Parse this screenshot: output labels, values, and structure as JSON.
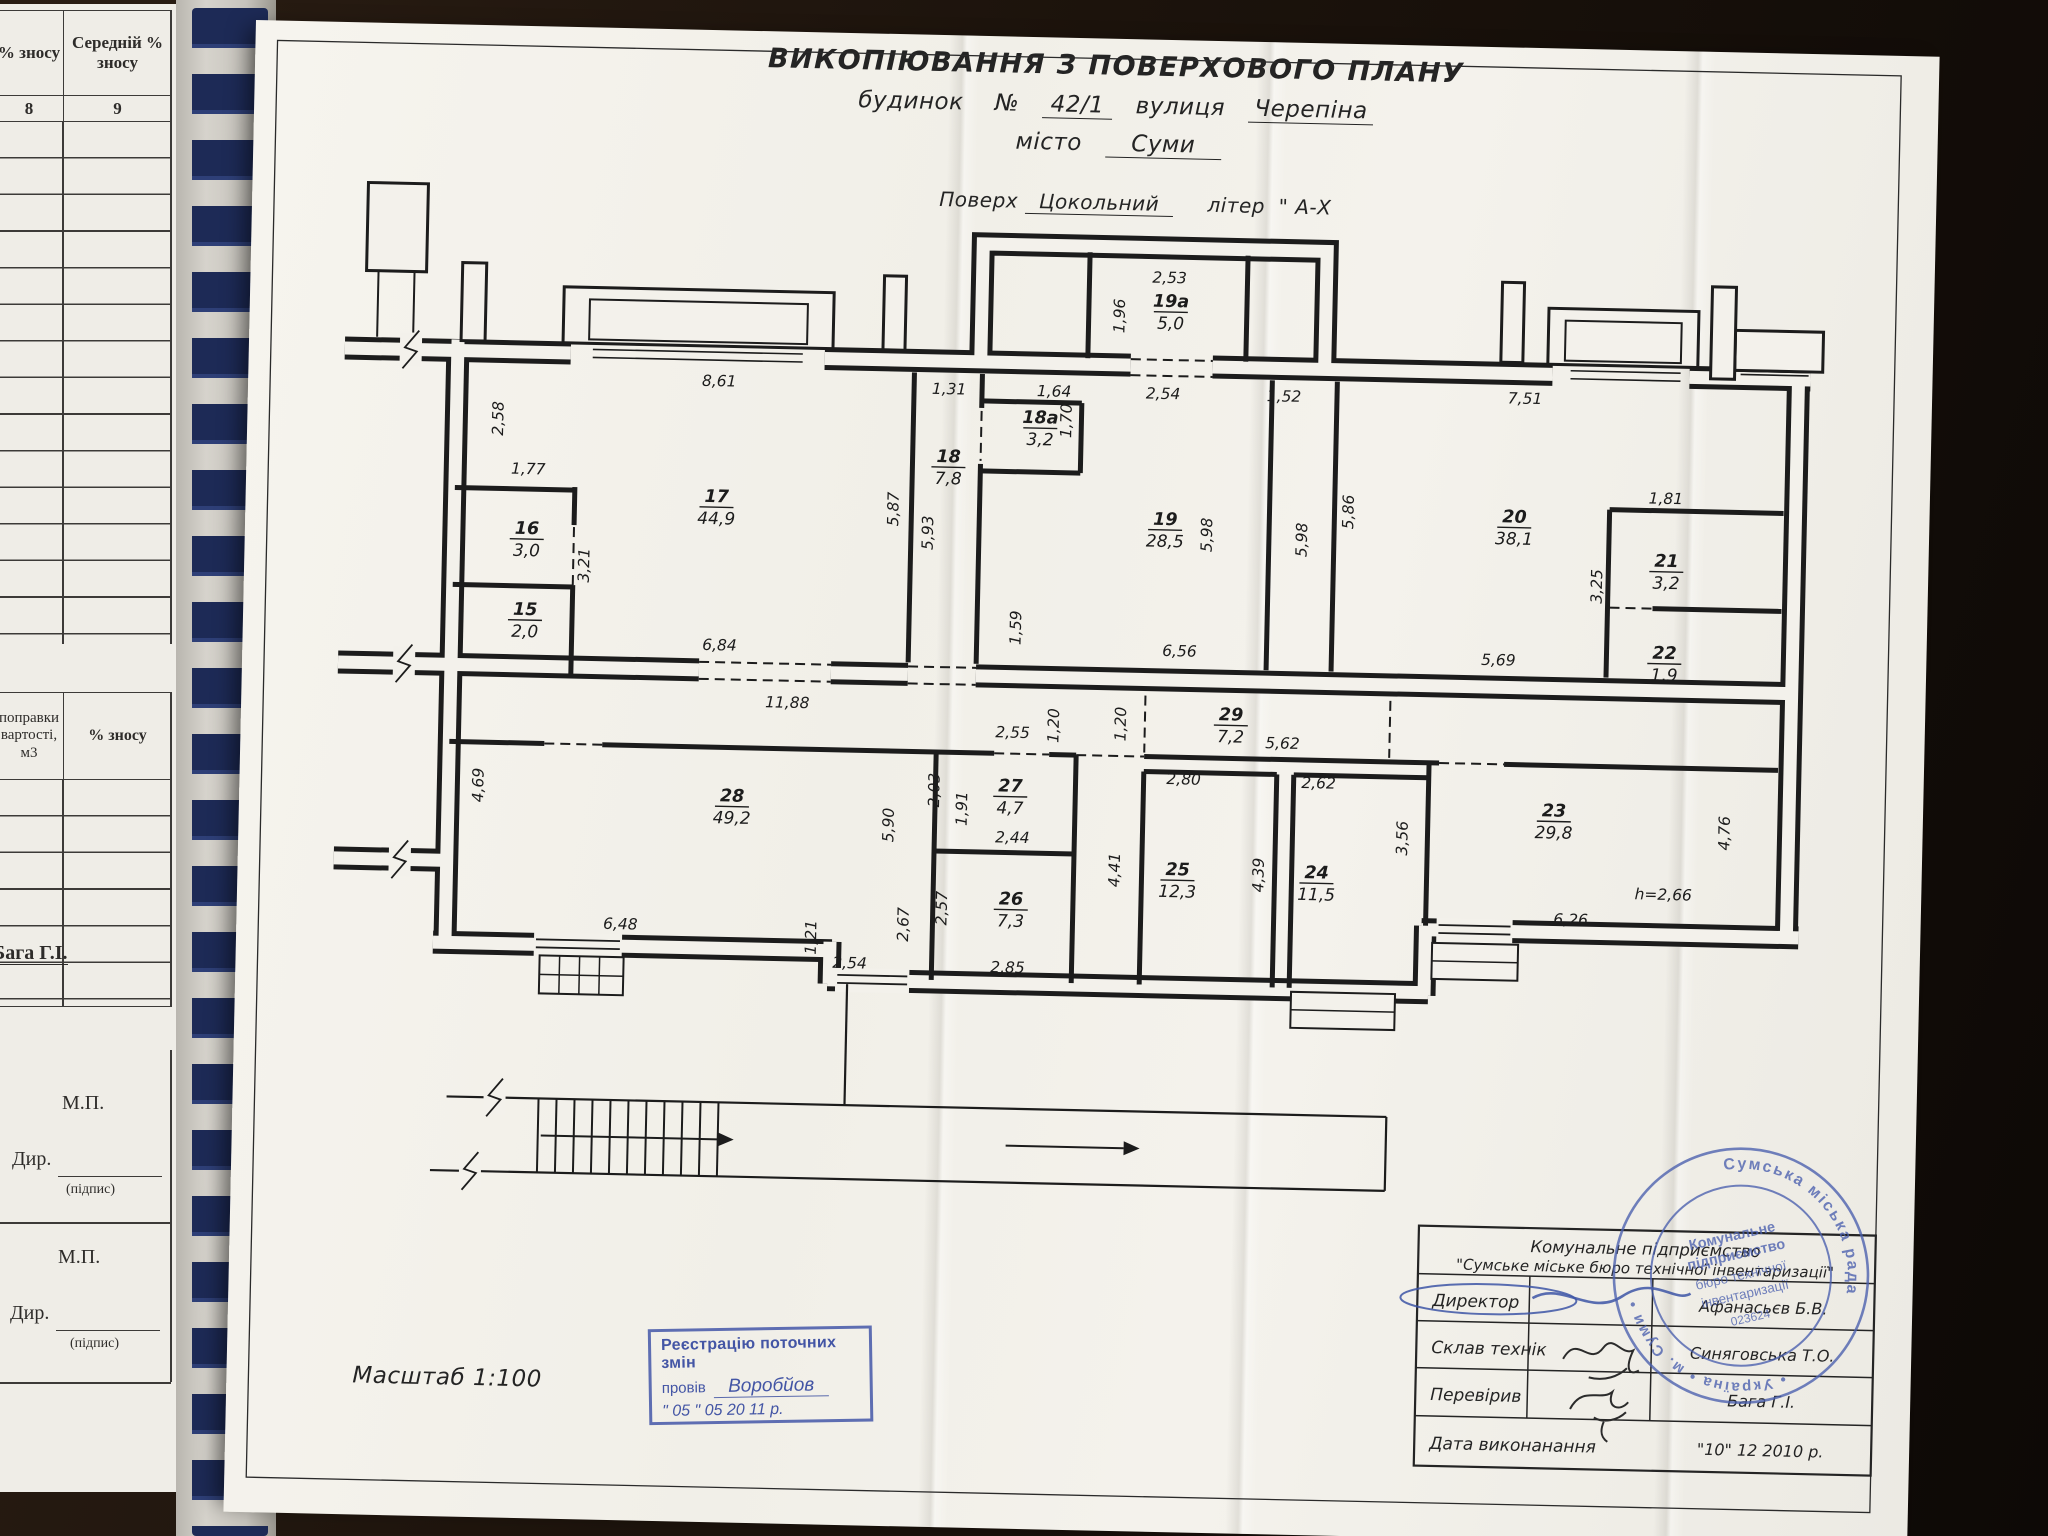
{
  "header": {
    "title": "ВИКОПІЮВАННЯ З ПОВЕРХОВОГО ПЛАНУ",
    "bld_label": "будинок",
    "no_label": "№",
    "house_no": "42/1",
    "street_label": "вулиця",
    "street": "Черепіна",
    "city_label": "місто",
    "city": "Суми",
    "floor_label": "Поверх",
    "floor": "Цокольний",
    "liter_label": "літер",
    "liter": "\" А-Х"
  },
  "scale_label": "Масштаб 1:100",
  "left_page": {
    "col8_header": "% зносу",
    "col9_header": "Середній % зносу",
    "col8_num": "8",
    "col9_num": "9",
    "t2_col1": "поправки вартості, м3",
    "t2_col2": "% зносу",
    "baga": "Бага Г.І.",
    "mp": "М.П.",
    "dir": "Дир.",
    "podpis": "(підпис)"
  },
  "plan": {
    "rooms": [
      {
        "n": "15",
        "a": "2,0",
        "x": 538,
        "y": 609
      },
      {
        "n": "16",
        "a": "3,0",
        "x": 538,
        "y": 528
      },
      {
        "n": "17",
        "a": "44,9",
        "x": 727,
        "y": 492
      },
      {
        "n": "18",
        "a": "7,8",
        "x": 958,
        "y": 447
      },
      {
        "n": "18а",
        "a": "3,2",
        "x": 1049,
        "y": 406
      },
      {
        "n": "19а",
        "a": "5,0",
        "x": 1177,
        "y": 287
      },
      {
        "n": "19",
        "a": "28,5",
        "x": 1176,
        "y": 505
      },
      {
        "n": "20",
        "a": "38,1",
        "x": 1525,
        "y": 495
      },
      {
        "n": "21",
        "a": "3,2",
        "x": 1678,
        "y": 536
      },
      {
        "n": "22",
        "a": "1,9",
        "x": 1678,
        "y": 628
      },
      {
        "n": "23",
        "a": "29,8",
        "x": 1571,
        "y": 788
      },
      {
        "n": "24",
        "a": "11,5",
        "x": 1335,
        "y": 855
      },
      {
        "n": "25",
        "a": "12,3",
        "x": 1196,
        "y": 855
      },
      {
        "n": "26",
        "a": "7,3",
        "x": 1030,
        "y": 888
      },
      {
        "n": "27",
        "a": "4,7",
        "x": 1027,
        "y": 775
      },
      {
        "n": "28",
        "a": "49,2",
        "x": 749,
        "y": 791
      },
      {
        "n": "29",
        "a": "7,2",
        "x": 1246,
        "y": 699
      }
    ],
    "dims": [
      {
        "t": "8,61",
        "x": 727,
        "y": 376
      },
      {
        "t": "2,58",
        "x": 512,
        "y": 413,
        "r": 1
      },
      {
        "t": "1,77",
        "x": 538,
        "y": 468
      },
      {
        "t": "3,21",
        "x": 601,
        "y": 558,
        "r": 1
      },
      {
        "t": "6,84",
        "x": 733,
        "y": 640
      },
      {
        "t": "1,31",
        "x": 957,
        "y": 379
      },
      {
        "t": "5,87",
        "x": 909,
        "y": 495,
        "r": 1
      },
      {
        "t": "5,93",
        "x": 944,
        "y": 518,
        "r": 1
      },
      {
        "t": "1,64",
        "x": 1062,
        "y": 379
      },
      {
        "t": "1,70",
        "x": 1080,
        "y": 403,
        "r": 1
      },
      {
        "t": "2,53",
        "x": 1175,
        "y": 263
      },
      {
        "t": "1,96",
        "x": 1131,
        "y": 297,
        "r": 1
      },
      {
        "t": "2,54",
        "x": 1171,
        "y": 379
      },
      {
        "t": "1,52",
        "x": 1292,
        "y": 379
      },
      {
        "t": "1,59",
        "x": 1034,
        "y": 611,
        "r": 1
      },
      {
        "t": "5,98",
        "x": 1223,
        "y": 514,
        "r": 1
      },
      {
        "t": "5,98",
        "x": 1318,
        "y": 517,
        "r": 1
      },
      {
        "t": "5,86",
        "x": 1364,
        "y": 488,
        "r": 1
      },
      {
        "t": "7,51",
        "x": 1533,
        "y": 376
      },
      {
        "t": "1,81",
        "x": 1676,
        "y": 473
      },
      {
        "t": "3,25",
        "x": 1614,
        "y": 557,
        "r": 1
      },
      {
        "t": "5,69",
        "x": 1512,
        "y": 638
      },
      {
        "t": "6,56",
        "x": 1193,
        "y": 636
      },
      {
        "t": "11,88",
        "x": 802,
        "y": 696
      },
      {
        "t": "2,55",
        "x": 1028,
        "y": 721
      },
      {
        "t": "1,20",
        "x": 1074,
        "y": 708,
        "r": 1
      },
      {
        "t": "1,20",
        "x": 1141,
        "y": 705,
        "r": 1
      },
      {
        "t": "5,62",
        "x": 1298,
        "y": 726
      },
      {
        "t": "2,03",
        "x": 956,
        "y": 775,
        "r": 1
      },
      {
        "t": "1,91",
        "x": 984,
        "y": 793,
        "r": 1
      },
      {
        "t": "5,90",
        "x": 911,
        "y": 811,
        "r": 1
      },
      {
        "t": "2,44",
        "x": 1030,
        "y": 826
      },
      {
        "t": "2,80",
        "x": 1200,
        "y": 764
      },
      {
        "t": "2,62",
        "x": 1335,
        "y": 765
      },
      {
        "t": "4,41",
        "x": 1138,
        "y": 851,
        "r": 1
      },
      {
        "t": "4,39",
        "x": 1282,
        "y": 853,
        "r": 1
      },
      {
        "t": "3,56",
        "x": 1425,
        "y": 813,
        "r": 1
      },
      {
        "t": "4,69",
        "x": 500,
        "y": 780,
        "r": 1
      },
      {
        "t": "2,57",
        "x": 966,
        "y": 893,
        "r": 1
      },
      {
        "t": "2,67",
        "x": 928,
        "y": 910,
        "r": 1
      },
      {
        "t": "1,21",
        "x": 836,
        "y": 925,
        "r": 1
      },
      {
        "t": "2,54",
        "x": 870,
        "y": 955
      },
      {
        "t": "2,85",
        "x": 1028,
        "y": 956
      },
      {
        "t": "6,48",
        "x": 640,
        "y": 921
      },
      {
        "t": "6,26",
        "x": 1590,
        "y": 896
      },
      {
        "t": "4,76",
        "x": 1747,
        "y": 801,
        "r": 1
      },
      {
        "t": "h=2,66",
        "x": 1682,
        "y": 869
      }
    ]
  },
  "title_block": {
    "org1": "Комунальне підприємство",
    "org2": "\"Сумське міське бюро технічної інвентаризації\"",
    "rows": [
      {
        "label": "Директор",
        "value": "Афанасьєв Б.В."
      },
      {
        "label": "Склав технік",
        "value": "Синяговська Т.О."
      },
      {
        "label": "Перевірив",
        "value": "Бага Г.І."
      }
    ],
    "date_label": "Дата виконанання",
    "date_value": "\"10\"   12   2010 р."
  },
  "reg_stamp": {
    "line1": "Реєстрацію поточних змін",
    "performed_label": "провів",
    "performed_name": "Воробйов",
    "date_line": "\" 05 \"      05      20 11 р."
  },
  "round_stamp": {
    "arc_top": "Сумська міська рада",
    "arc_bottom": "•  Україна  •  м. Суми  •",
    "center_lines": [
      "Комунальне",
      "підприємство",
      "бюро технічної",
      "інвентаризації",
      "023624"
    ]
  },
  "colors": {
    "ink": "#1c1c1c",
    "blue": "#4a5fae",
    "paper": "#f3f1eb"
  }
}
